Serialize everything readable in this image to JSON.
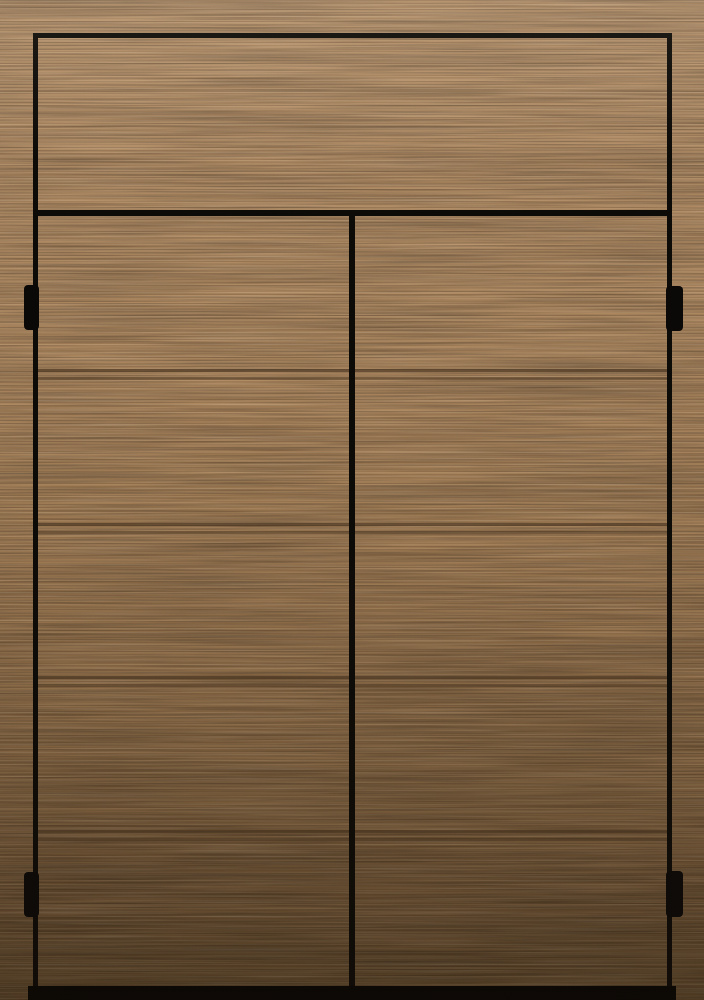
{
  "scene": {
    "subject": "Double wardrobe doors with upper transom panel in light oak veneer",
    "material": "rift-cut oak veneer, fine horizontal grain",
    "door_count": 2,
    "grooves_per_door": 4,
    "hinge_count": 4
  },
  "colors": {
    "wood_top": "#b4906a",
    "wood_upper": "#ac875f",
    "wood_mid": "#9f7b54",
    "wood_lower": "#8a6a46",
    "wood_deep": "#755939",
    "wood_bottom": "#664e30",
    "outline": "#0d0b08",
    "groove": "#46321f",
    "hinge": "#0a0908",
    "bottom_gap": "#070605"
  }
}
